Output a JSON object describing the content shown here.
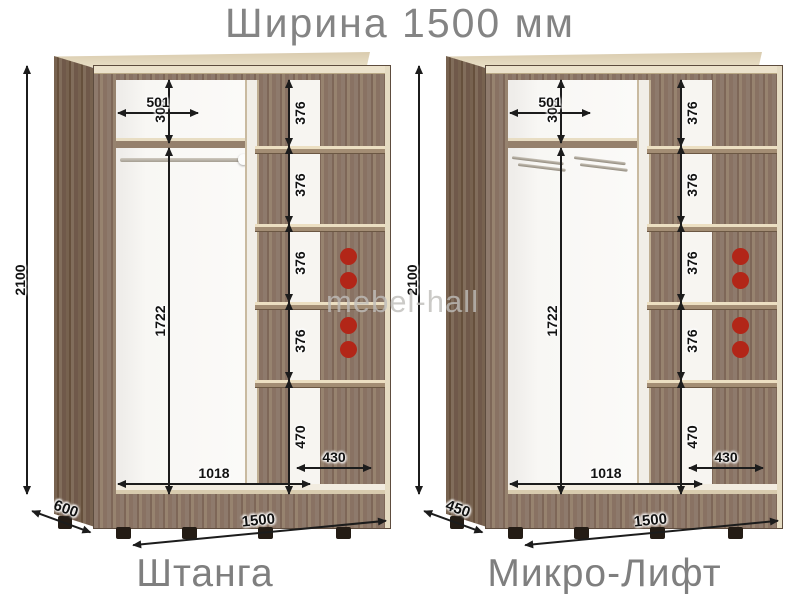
{
  "title": "Ширина 1500 мм",
  "watermark": "mebel-hall",
  "colors": {
    "accent_red": "#b22618",
    "heading_gray": "#848484",
    "wood": "#8e7a6c",
    "wood_dark": "#70594a",
    "cream_edge": "#ece2cb",
    "dim_line": "#1c1c1c"
  },
  "cabinets": [
    {
      "label": "Штанга",
      "type": "rod",
      "dims": {
        "height": "2100",
        "top_section_height": "300",
        "top_section_width": "501",
        "hanging_height": "1722",
        "shelf_gaps": [
          "376",
          "376",
          "376",
          "376"
        ],
        "bottom_section": "470",
        "door_width": "1018",
        "shelf_width": "430",
        "total_width": "1500",
        "depth": "600"
      }
    },
    {
      "label": "Микро-Лифт",
      "type": "micro-lift",
      "dims": {
        "height": "2100",
        "top_section_height": "300",
        "top_section_width": "501",
        "hanging_height": "1722",
        "shelf_gaps": [
          "376",
          "376",
          "376",
          "376"
        ],
        "bottom_section": "470",
        "door_width": "1018",
        "shelf_width": "430",
        "total_width": "1500",
        "depth": "450"
      }
    }
  ]
}
